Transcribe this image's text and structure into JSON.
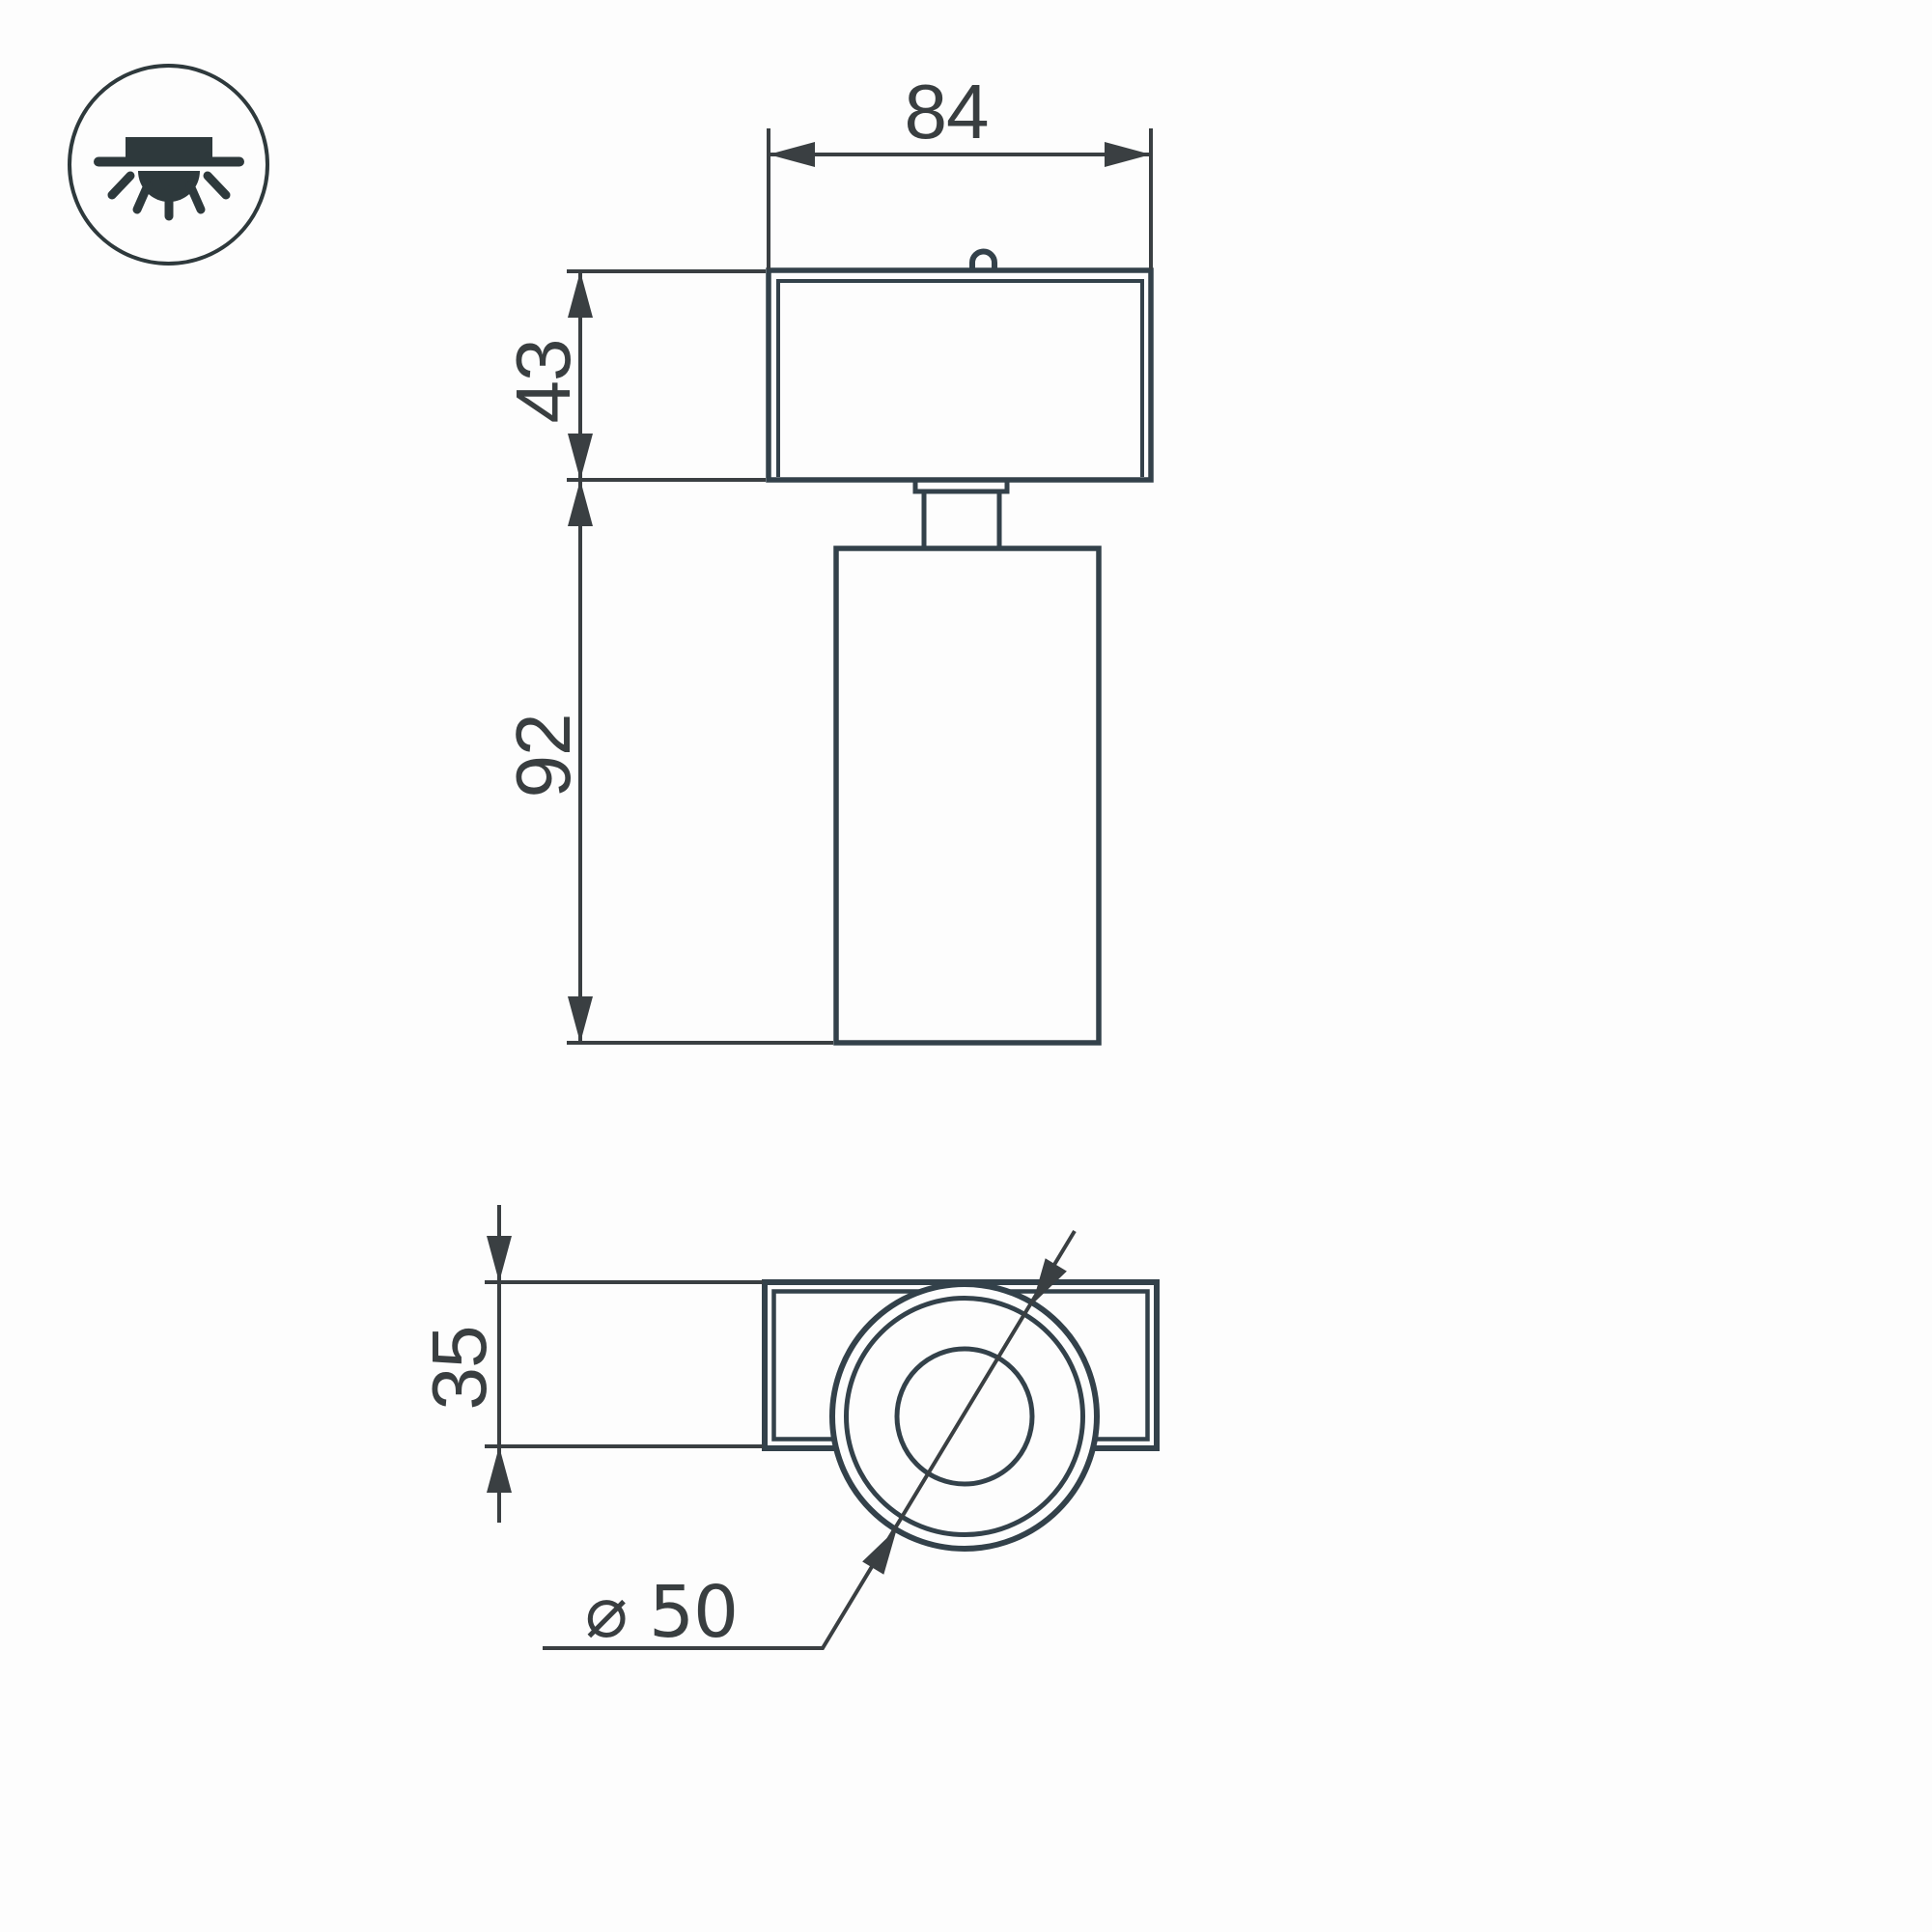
{
  "icon": {
    "name": "recessed-downlight-icon",
    "description": "ceiling recessed luminaire symbol in circle"
  },
  "colors": {
    "background": "#fdfdfd",
    "object_line": "#33414a",
    "dimension_line": "#3a3f42",
    "icon_line": "#2e393c"
  },
  "views": {
    "front": {
      "name": "front-elevation",
      "parts": [
        "track-mount-box",
        "mount-loop",
        "swivel-flange",
        "swivel-neck",
        "cylindrical-lamp-body"
      ]
    },
    "bottom": {
      "name": "bottom-plan",
      "parts": [
        "mount-plate",
        "lamp-bezel-rings",
        "lens-opening"
      ]
    }
  },
  "dimensions": {
    "front_width": "84",
    "head_height": "43",
    "body_height": "92",
    "plate_height": "35",
    "body_diameter": "⌀ 50"
  }
}
